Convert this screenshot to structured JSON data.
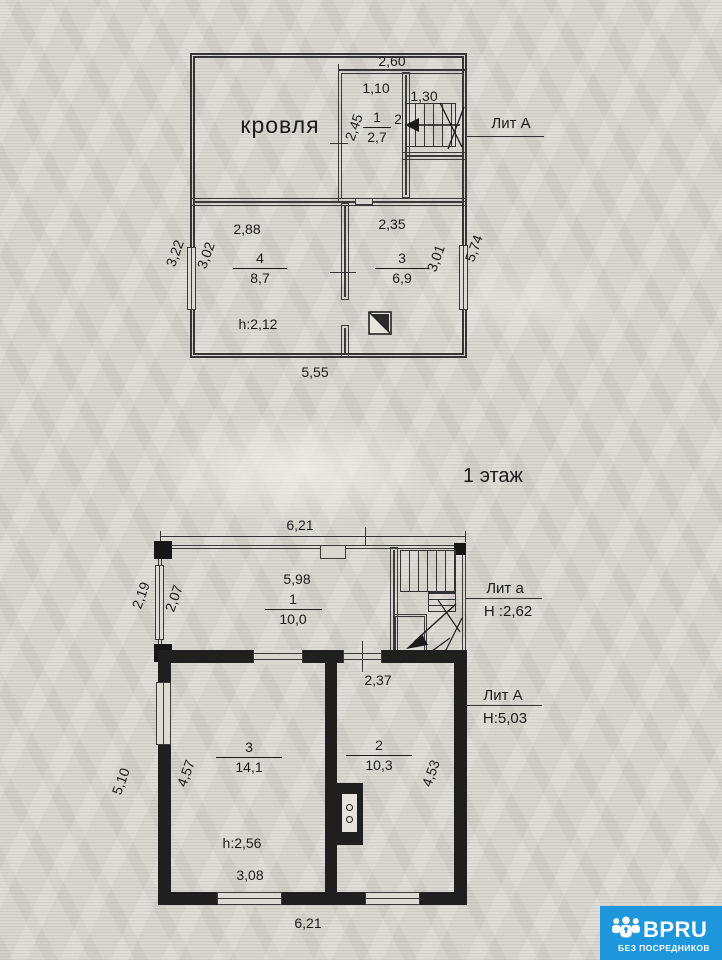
{
  "attic": {
    "title": "кровля",
    "lit": "Лит А",
    "d_top": "2,60",
    "r1_w": "1,10",
    "r1_h": "2,45",
    "r1_num": "1",
    "r1_area": "2,7",
    "st_num": "2",
    "st_w": "1,30",
    "r4_top": "2,88",
    "r3_top": "2,35",
    "out_left": "3,22",
    "r4_left": "3,02",
    "r4_num": "4",
    "r4_area": "8,7",
    "h_label": "h:2,12",
    "r3_num": "3",
    "r3_area": "6,9",
    "r3_right": "3,01",
    "out_right": "5,74",
    "d_bottom": "5,55"
  },
  "floor1": {
    "title": "1 этаж",
    "d_top": "6,21",
    "v_top": "5,98",
    "r1_num": "1",
    "r1_area": "10,0",
    "out_left": "2,19",
    "in_left": "2,07",
    "lit_a": "Лит а",
    "lit_a_h": "Н :2,62",
    "lit_A": "Лит А",
    "lit_A_h": "Н:5,03",
    "r2_top": "2,37",
    "r2_num": "2",
    "r2_area": "10,3",
    "r2_right": "4,53",
    "r3_num": "3",
    "r3_area": "14,1",
    "r3_left": "4,57",
    "out_left_main": "5,10",
    "h_label": "h:2,56",
    "r3_bottom": "3,08",
    "d_bottom": "6,21"
  },
  "logo": {
    "brand": "BPRU",
    "tagline": "БЕЗ ПОСРЕДНИКОВ"
  },
  "colors": {
    "logo_bg": "#1d96dc",
    "ink": "#1f1f1f",
    "paper": "#d8d5ce"
  }
}
